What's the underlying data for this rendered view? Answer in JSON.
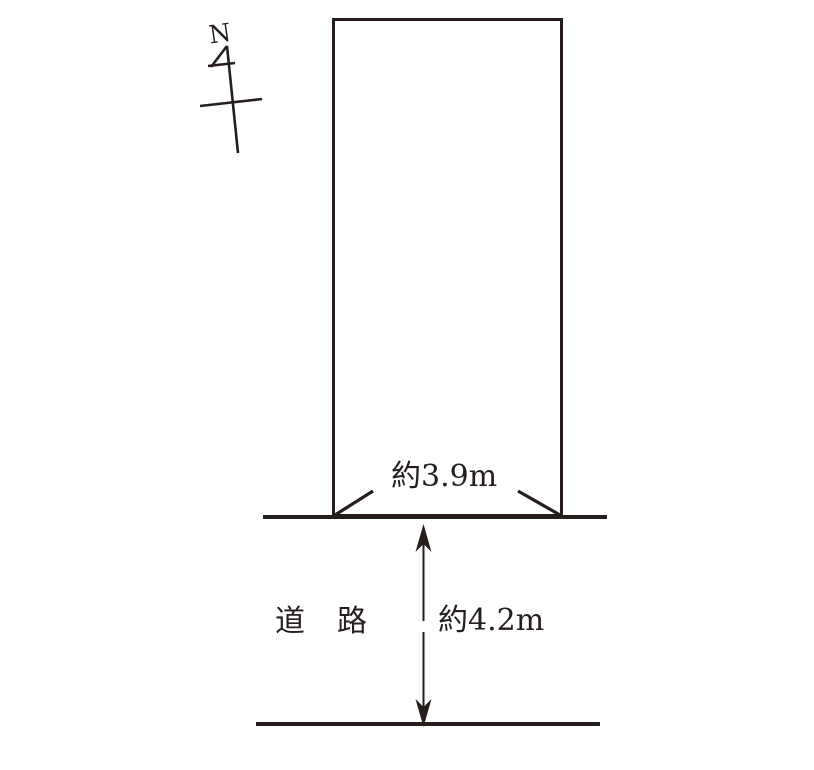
{
  "diagram": {
    "type": "land-plot-site-plan",
    "compass": {
      "north_label": "N"
    },
    "plot": {
      "frontage_label": "約3.9m"
    },
    "road": {
      "name_label": "道　路",
      "width_label": "約4.2m"
    },
    "colors": {
      "line": "#251e1c",
      "background": "#ffffff"
    }
  }
}
